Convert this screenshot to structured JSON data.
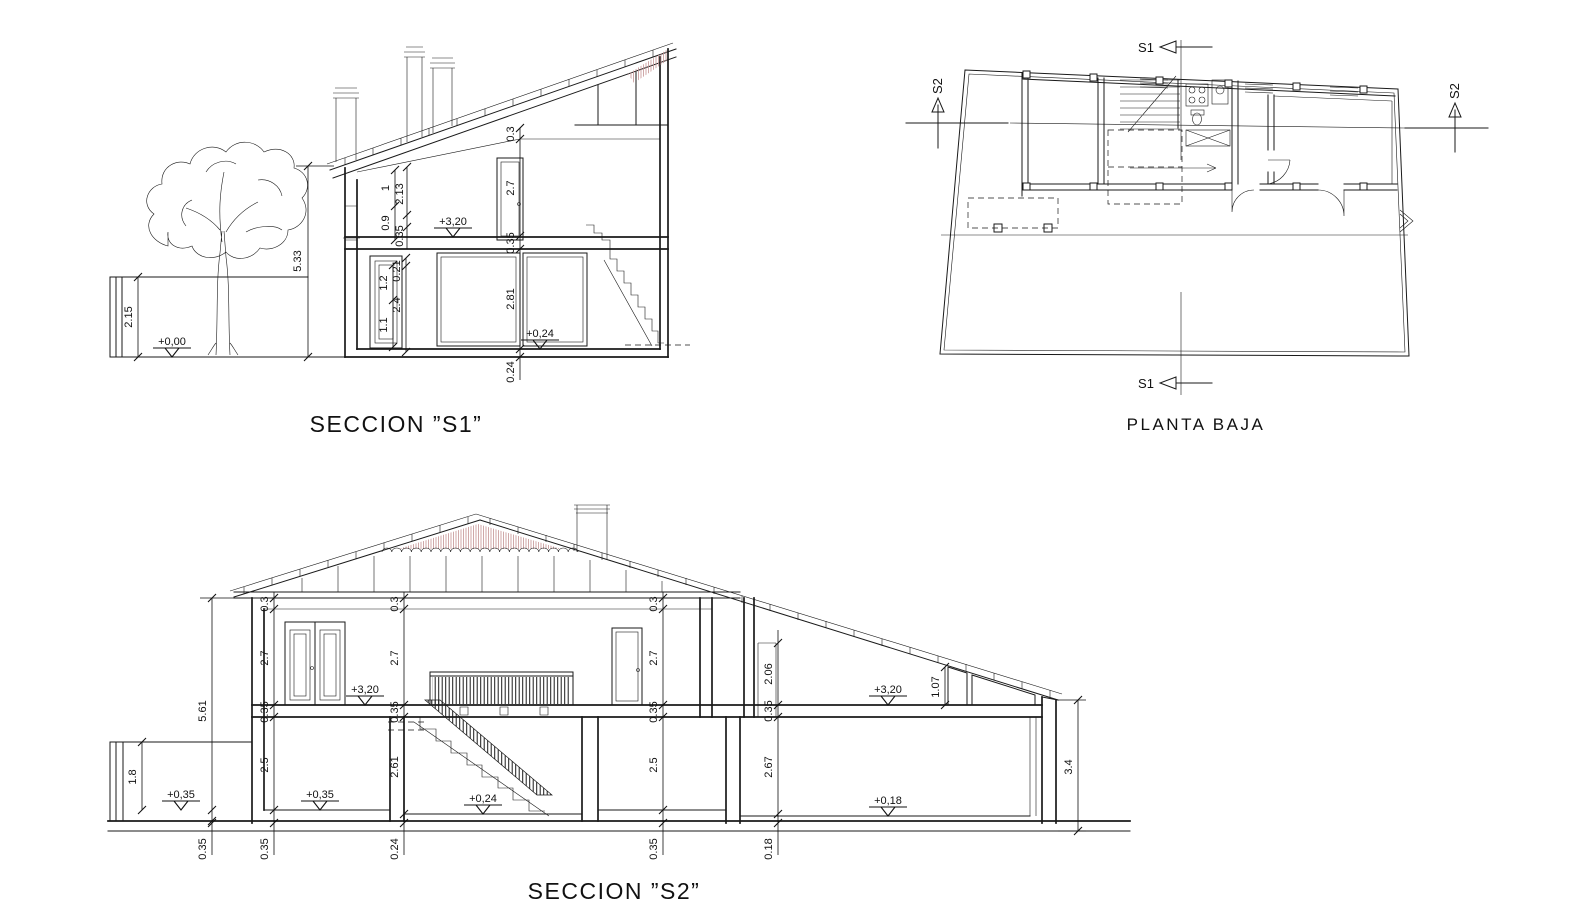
{
  "meta": {
    "background": "#ffffff",
    "ink": "#1a1a1a",
    "roof_tint": "#c59292"
  },
  "s1": {
    "title": "SECCION ”S1”",
    "levels": {
      "ground": "+0,00",
      "upper_floor": "+3,20",
      "entry": "+0,24"
    },
    "left_dims": {
      "yard_wall": "2.15",
      "total_height": "5.33"
    },
    "upper_window_dims": [
      "1",
      "2.13",
      "0.9",
      "0.35"
    ],
    "mid_chain": [
      "0.3",
      "2.7",
      "0.35",
      "2.81",
      "0.24"
    ],
    "lower_window_dims": [
      "0.21",
      "1.2",
      "2.4",
      "1.1"
    ]
  },
  "plan": {
    "title": "PLANTA BAJA",
    "section_marker_s1": "S1",
    "section_marker_s2": "S2"
  },
  "s2": {
    "title": "SECCION ”S2”",
    "levels": {
      "yard": "+0,35",
      "ground_left": "+0,35",
      "upper_left": "+3,20",
      "stair_hall": "+0,24",
      "upper_right": "+3,20",
      "ground_right": "+0,18"
    },
    "left_dims": {
      "total_height": "5.61",
      "yard_wall": "1.8",
      "foundation": "0.35"
    },
    "chain_a": [
      "0.3",
      "2.7",
      "0.35",
      "2.5",
      "0.35"
    ],
    "chain_b": [
      "0.3",
      "2.7",
      "0.35",
      "2.61",
      "0.24"
    ],
    "chain_c": [
      "0.3",
      "2.7",
      "0.35",
      "2.5",
      "0.35"
    ],
    "chain_d": [
      "2.06",
      "0.35",
      "2.67",
      "0.18"
    ],
    "right_dims": {
      "roof_window": "1.07",
      "right_wall": "3.4"
    }
  }
}
